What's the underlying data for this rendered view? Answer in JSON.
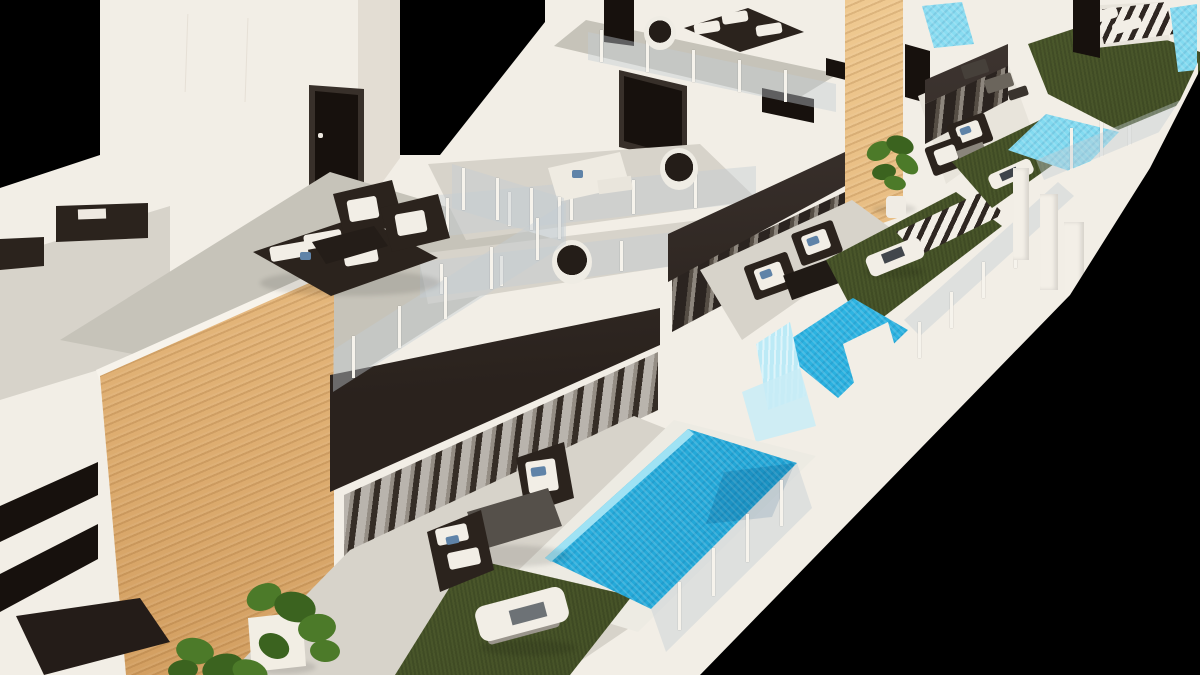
{
  "scene": {
    "subject": "Aerial 3D architectural render of a row of modern white villas, each with a private tiled swimming pool, lawn, roof terrace, dark awnings and a timber-slat feature wall, shown on a black background",
    "render_style": "photorealistic CGI, aerial three-quarter view, villas receding diagonally from lower-left foreground to upper-right background",
    "background": "#000000"
  },
  "colors": {
    "black": "#000000",
    "wall": "#f2eee6",
    "wallShade": "#e3ddd3",
    "floor": "#d7d3ca",
    "floorRoof": "#c6c3b9",
    "patio": "#e8e4db",
    "surround": "#edebe3",
    "awning": "#2a221d",
    "awningTop": "#453c38",
    "wood": "#e2b377",
    "woodLight": "#f0cb93",
    "woodDark": "#d29e60",
    "window": "#17110d",
    "frame": "#38302a",
    "pool": "#2db4e2",
    "poolDeep": "#1a9cce",
    "poolLight": "#7fd9f0",
    "poolPale": "#c9ecf6",
    "grass": "#4c592c",
    "grassDark": "#3d4921",
    "post": "#f6f3ec",
    "glass": "rgba(195,205,212,0.42)",
    "cushion": "#f2eee6",
    "pillow": "#5f83a8",
    "furnDark": "#2b231d",
    "tableGrey": "#55504a",
    "leaf": "#4c7a29",
    "leafDark": "#3b631f"
  },
  "inventory": {
    "villas_visible": 4,
    "pools_visible": 5,
    "roof_terraces": 2,
    "balconies": 2,
    "lawns": 4,
    "sun_loungers": 5,
    "hanging_chairs": 3,
    "outdoor_seating_groups": 5,
    "timber_feature_walls": 2,
    "dark_awnings": 4,
    "potted_plants": 2,
    "outdoor_kitchens": 1
  }
}
